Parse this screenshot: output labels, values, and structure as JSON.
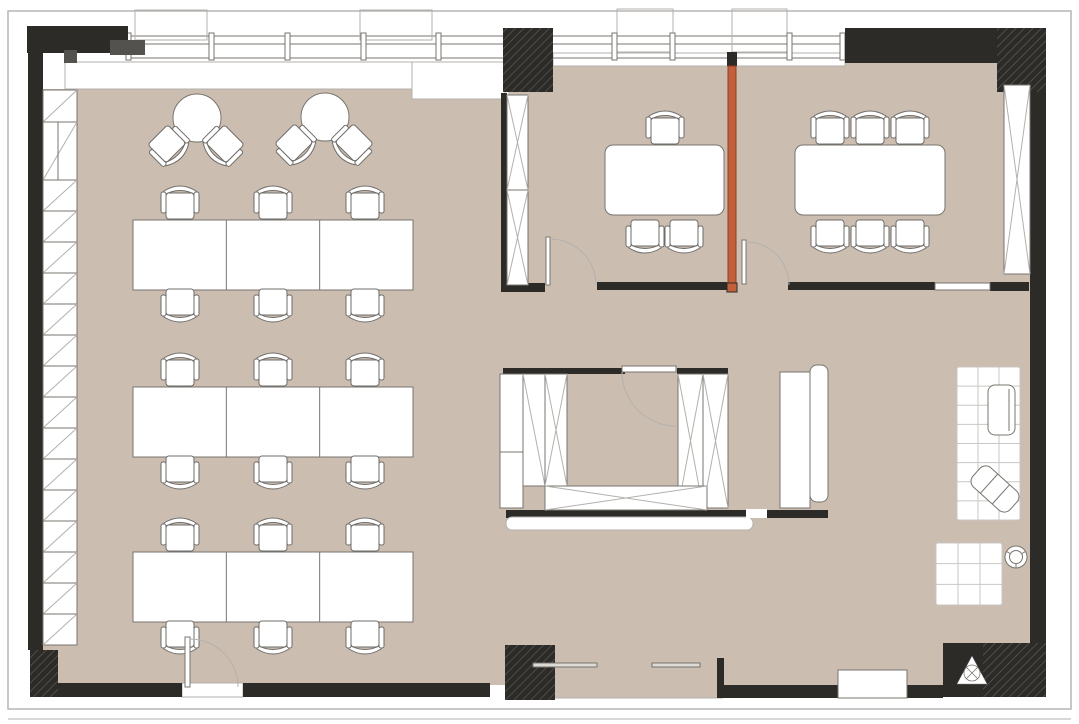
{
  "scene": {
    "type": "office-floor-plan",
    "width": 1079,
    "height": 724
  },
  "palette": {
    "floor": "#cbbdb0",
    "wall": "#2d2b28",
    "accent_orange": "#c2603c",
    "accent_orange_edge": "#8f3d22",
    "line": "#77756f",
    "light_line": "#b3b1ad",
    "white": "#ffffff",
    "hatch_line": "#5d5b57",
    "gray_block": "#54524e"
  },
  "frame": {
    "outer": [
      8,
      11,
      1063,
      698
    ],
    "bottom_line_y": 719
  },
  "floor_rects": [
    [
      43,
      89,
      369,
      596
    ],
    [
      412,
      99,
      96,
      586
    ],
    [
      508,
      63,
      524,
      622
    ],
    [
      555,
      685,
      168,
      13
    ]
  ],
  "white_bands": [
    [
      65,
      62,
      347,
      27
    ],
    [
      412,
      62,
      93,
      37
    ],
    [
      553,
      53,
      292,
      13
    ],
    [
      182,
      683,
      61,
      14
    ]
  ],
  "storefront_line": [
    530,
    698,
    723,
    698
  ],
  "windows": {
    "lines_y": [
      36,
      44,
      58
    ],
    "x1": 128,
    "x2": 845,
    "mullions": [
      126,
      209,
      285,
      361,
      436,
      612,
      670,
      787,
      840
    ],
    "mullion_y": 33,
    "mullion_h": 27,
    "balcony_boxes": [
      [
        135,
        10,
        72,
        30
      ],
      [
        360,
        10,
        72,
        30
      ],
      [
        617,
        9,
        56,
        43
      ],
      [
        732,
        9,
        55,
        43
      ]
    ]
  },
  "walls": [
    [
      27,
      26,
      101,
      27
    ],
    [
      28,
      40,
      15,
      610
    ],
    [
      56,
      683,
      126,
      14
    ],
    [
      243,
      683,
      247,
      14
    ],
    [
      723,
      685,
      220,
      13
    ],
    [
      845,
      28,
      152,
      35
    ],
    [
      501,
      93,
      6,
      192
    ],
    [
      501,
      283,
      44,
      9
    ],
    [
      597,
      282,
      130,
      8
    ],
    [
      788,
      282,
      147,
      8
    ],
    [
      990,
      282,
      39,
      9
    ],
    [
      1030,
      83,
      16,
      560
    ],
    [
      943,
      643,
      103,
      54
    ],
    [
      717,
      658,
      7,
      40
    ],
    [
      503,
      368,
      122,
      6
    ],
    [
      677,
      368,
      51,
      6
    ],
    [
      506,
      510,
      240,
      8
    ],
    [
      767,
      510,
      61,
      8
    ],
    [
      727,
      52,
      10,
      14
    ]
  ],
  "gray_blocks": [
    [
      110,
      40,
      35,
      15
    ],
    [
      64,
      50,
      13,
      13
    ]
  ],
  "hatched_blocks": [
    [
      503,
      28,
      50,
      64
    ],
    [
      997,
      28,
      49,
      64
    ],
    [
      505,
      645,
      50,
      55
    ],
    [
      30,
      650,
      28,
      47
    ],
    [
      983,
      643,
      63,
      54
    ]
  ],
  "orange_partition": {
    "wall": [
      728,
      66,
      8,
      217
    ],
    "bottom_block": [
      727,
      283,
      10,
      9
    ]
  },
  "sill": [
    935,
    283,
    55,
    7
  ],
  "bench": [
    838,
    670,
    69,
    28
  ],
  "tracks": [
    [
      533,
      663,
      64,
      4
    ],
    [
      652,
      663,
      48,
      4
    ]
  ],
  "shelving": {
    "x": 43,
    "w": 34,
    "top_cells": [
      [
        90,
        32
      ],
      [
        122,
        58
      ]
    ],
    "repeat": {
      "y0": 180,
      "h": 31,
      "count": 15
    }
  },
  "storage": {
    "apron": [
      506,
      517,
      247,
      13
    ],
    "gap_white": [
      746,
      509,
      21,
      9
    ],
    "left_cabinet": {
      "r": [
        500,
        374,
        23,
        134
      ],
      "divider_y": 452
    },
    "tv_cabinet": [
      780,
      372,
      30,
      136
    ],
    "tv_panel": [
      810,
      365,
      18,
      137
    ]
  },
  "x_panels": [
    {
      "r": [
        507,
        95,
        21,
        190
      ],
      "rows": 2,
      "cols": 1,
      "mode": "x"
    },
    {
      "r": [
        1004,
        85,
        26,
        189
      ],
      "rows": 1,
      "cols": 1,
      "mode": "x"
    },
    {
      "r": [
        523,
        374,
        44,
        112
      ],
      "rows": 1,
      "cols": 2,
      "mode": "mixed"
    },
    {
      "r": [
        678,
        374,
        50,
        134
      ],
      "rows": 1,
      "cols": 2,
      "mode": "x"
    },
    {
      "r": [
        545,
        486,
        162,
        24
      ],
      "rows": 1,
      "cols": 1,
      "mode": "x"
    }
  ],
  "desks": {
    "x": 133,
    "w": 280,
    "h": 70,
    "rows_y": [
      220,
      387,
      552
    ],
    "segments": 3
  },
  "meeting_tables": [
    [
      605,
      145,
      119,
      70
    ],
    [
      795,
      145,
      150,
      70
    ]
  ],
  "round_tables": [
    [
      197,
      118,
      24
    ],
    [
      325,
      117,
      24
    ]
  ],
  "chairs": [
    [
      180,
      203,
      0
    ],
    [
      273,
      203,
      0
    ],
    [
      365,
      203,
      0
    ],
    [
      180,
      305,
      180
    ],
    [
      273,
      305,
      180
    ],
    [
      365,
      305,
      180
    ],
    [
      180,
      370,
      0
    ],
    [
      273,
      370,
      0
    ],
    [
      365,
      370,
      0
    ],
    [
      180,
      472,
      180
    ],
    [
      273,
      472,
      180
    ],
    [
      365,
      472,
      180
    ],
    [
      180,
      535,
      0
    ],
    [
      273,
      535,
      0
    ],
    [
      365,
      535,
      0
    ],
    [
      180,
      637,
      180
    ],
    [
      273,
      637,
      180
    ],
    [
      365,
      637,
      180
    ],
    [
      169,
      146,
      135
    ],
    [
      223,
      146,
      -135
    ],
    [
      296,
      145,
      135
    ],
    [
      352,
      145,
      -135
    ],
    [
      665,
      128,
      0
    ],
    [
      645,
      236,
      180
    ],
    [
      684,
      236,
      180
    ],
    [
      830,
      128,
      0
    ],
    [
      870,
      128,
      0
    ],
    [
      910,
      128,
      0
    ],
    [
      830,
      236,
      180
    ],
    [
      870,
      236,
      180
    ],
    [
      910,
      236,
      180
    ]
  ],
  "doors": [
    {
      "leaf": [
        185,
        637,
        5,
        50
      ],
      "arc": "M190,639 A48,48 0 0 1 238,687"
    },
    {
      "leaf": [
        546,
        237,
        4,
        48
      ],
      "arc": "M550,239 A46,46 0 0 1 596,285"
    },
    {
      "leaf": [
        742,
        240,
        4,
        44
      ],
      "arc": "M746,242 A43,43 0 0 1 789,285"
    },
    {
      "leaf": [
        622,
        366,
        54,
        6
      ],
      "arc": "M622,372 A54,54 0 0 0 676,426"
    }
  ],
  "lounge": {
    "rugs": [
      {
        "r": [
          957,
          367,
          63,
          153
        ],
        "cols": 3,
        "rows": 8
      },
      {
        "r": [
          936,
          543,
          66,
          62
        ],
        "cols": 3,
        "rows": 3
      }
    ],
    "chair_vertical": [
      988,
      385,
      27,
      50
    ],
    "chair_diagonal": {
      "c": [
        995,
        489
      ],
      "size": [
        50,
        26
      ],
      "rot": 42
    },
    "stool": [
      1016,
      557,
      11
    ]
  },
  "triangle_symbol": {
    "pts": "972,656 957,684 987,684",
    "circle": [
      972,
      673,
      8
    ]
  }
}
